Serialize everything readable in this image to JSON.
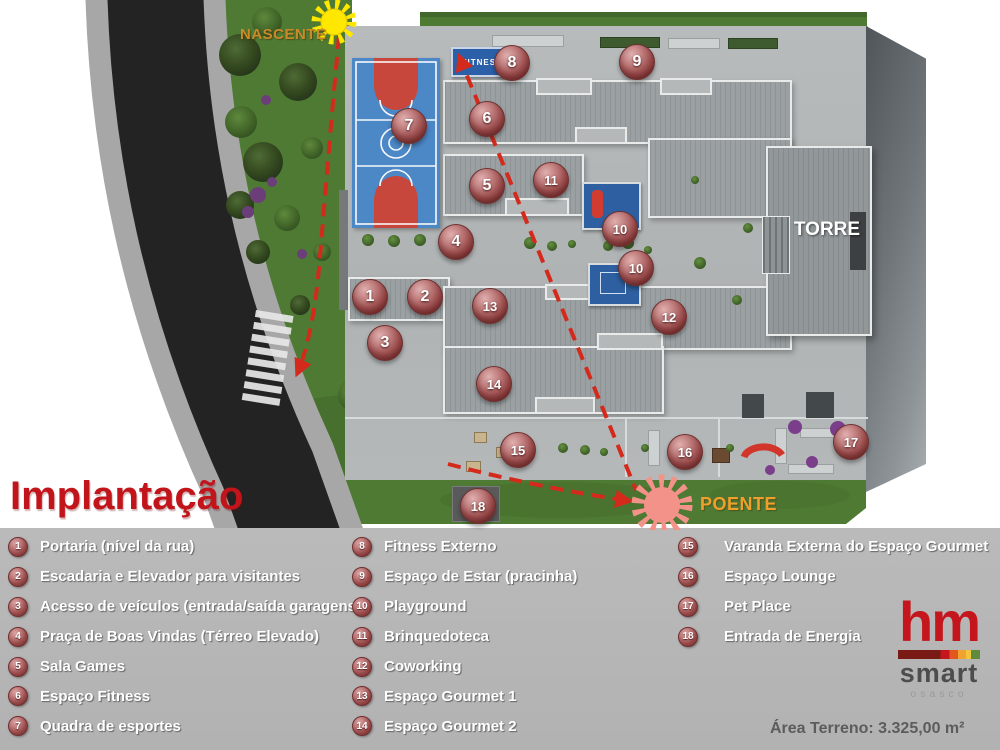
{
  "page": {
    "title": "Implantação",
    "area_label": "Área Terreno: 3.325,00 m²"
  },
  "plan": {
    "nascente_label": "NASCENTE",
    "poente_label": "POENTE",
    "torre_label": "TORRE",
    "fitness_sign": "FITNESS"
  },
  "legend": {
    "columns": [
      {
        "items": [
          {
            "num": "1",
            "label": "Portaria (nível da rua)"
          },
          {
            "num": "2",
            "label": "Escadaria e Elevador para visitantes"
          },
          {
            "num": "3",
            "label": "Acesso de veículos (entrada/saída garagens)"
          },
          {
            "num": "4",
            "label": "Praça de Boas Vindas (Térreo Elevado)"
          },
          {
            "num": "5",
            "label": "Sala Games"
          },
          {
            "num": "6",
            "label": "Espaço Fitness"
          },
          {
            "num": "7",
            "label": "Quadra de esportes"
          }
        ]
      },
      {
        "items": [
          {
            "num": "8",
            "label": "Fitness Externo"
          },
          {
            "num": "9",
            "label": "Espaço de Estar (pracinha)"
          },
          {
            "num": "10",
            "label": "Playground"
          },
          {
            "num": "11",
            "label": "Brinquedoteca"
          },
          {
            "num": "12",
            "label": "Coworking"
          },
          {
            "num": "13",
            "label": "Espaço Gourmet 1"
          },
          {
            "num": "14",
            "label": "Espaço Gourmet 2"
          }
        ]
      },
      {
        "items": [
          {
            "num": "15",
            "label": "Varanda Externa do Espaço Gourmet"
          },
          {
            "num": "16",
            "label": "Espaço Lounge"
          },
          {
            "num": "17",
            "label": "Pet Place"
          },
          {
            "num": "18",
            "label": "Entrada de Energia"
          }
        ]
      }
    ]
  },
  "markers": [
    {
      "num": "1",
      "x": 370,
      "y": 297
    },
    {
      "num": "2",
      "x": 425,
      "y": 297
    },
    {
      "num": "3",
      "x": 385,
      "y": 343
    },
    {
      "num": "4",
      "x": 456,
      "y": 242
    },
    {
      "num": "5",
      "x": 487,
      "y": 186
    },
    {
      "num": "6",
      "x": 487,
      "y": 119
    },
    {
      "num": "7",
      "x": 409,
      "y": 126
    },
    {
      "num": "8",
      "x": 512,
      "y": 63
    },
    {
      "num": "9",
      "x": 637,
      "y": 62
    },
    {
      "num": "10",
      "x": 620,
      "y": 229
    },
    {
      "num": "10",
      "x": 636,
      "y": 268
    },
    {
      "num": "11",
      "x": 551,
      "y": 180
    },
    {
      "num": "12",
      "x": 669,
      "y": 317
    },
    {
      "num": "13",
      "x": 490,
      "y": 306
    },
    {
      "num": "14",
      "x": 494,
      "y": 384
    },
    {
      "num": "15",
      "x": 518,
      "y": 450
    },
    {
      "num": "16",
      "x": 685,
      "y": 452
    },
    {
      "num": "17",
      "x": 851,
      "y": 442
    },
    {
      "num": "18",
      "x": 478,
      "y": 506
    }
  ],
  "logo": {
    "hm": "hm",
    "smart": "smart",
    "city": "osasco"
  },
  "colors": {
    "accent_red": "#C2151B",
    "marker_red": "#A25454",
    "legend_bg": "#B5B5B5",
    "nascente_orange": "#C98A2A",
    "poente_orange": "#EF9F2E",
    "sun_yellow": "#FFE800",
    "sun_salmon": "#F29289",
    "court_blue": "#4C87C6",
    "court_key_red": "#C8473C",
    "fitness_sign_blue": "#2B5FA8",
    "logo_red": "#C4161C",
    "dashed_path_red": "#D42A1C"
  }
}
